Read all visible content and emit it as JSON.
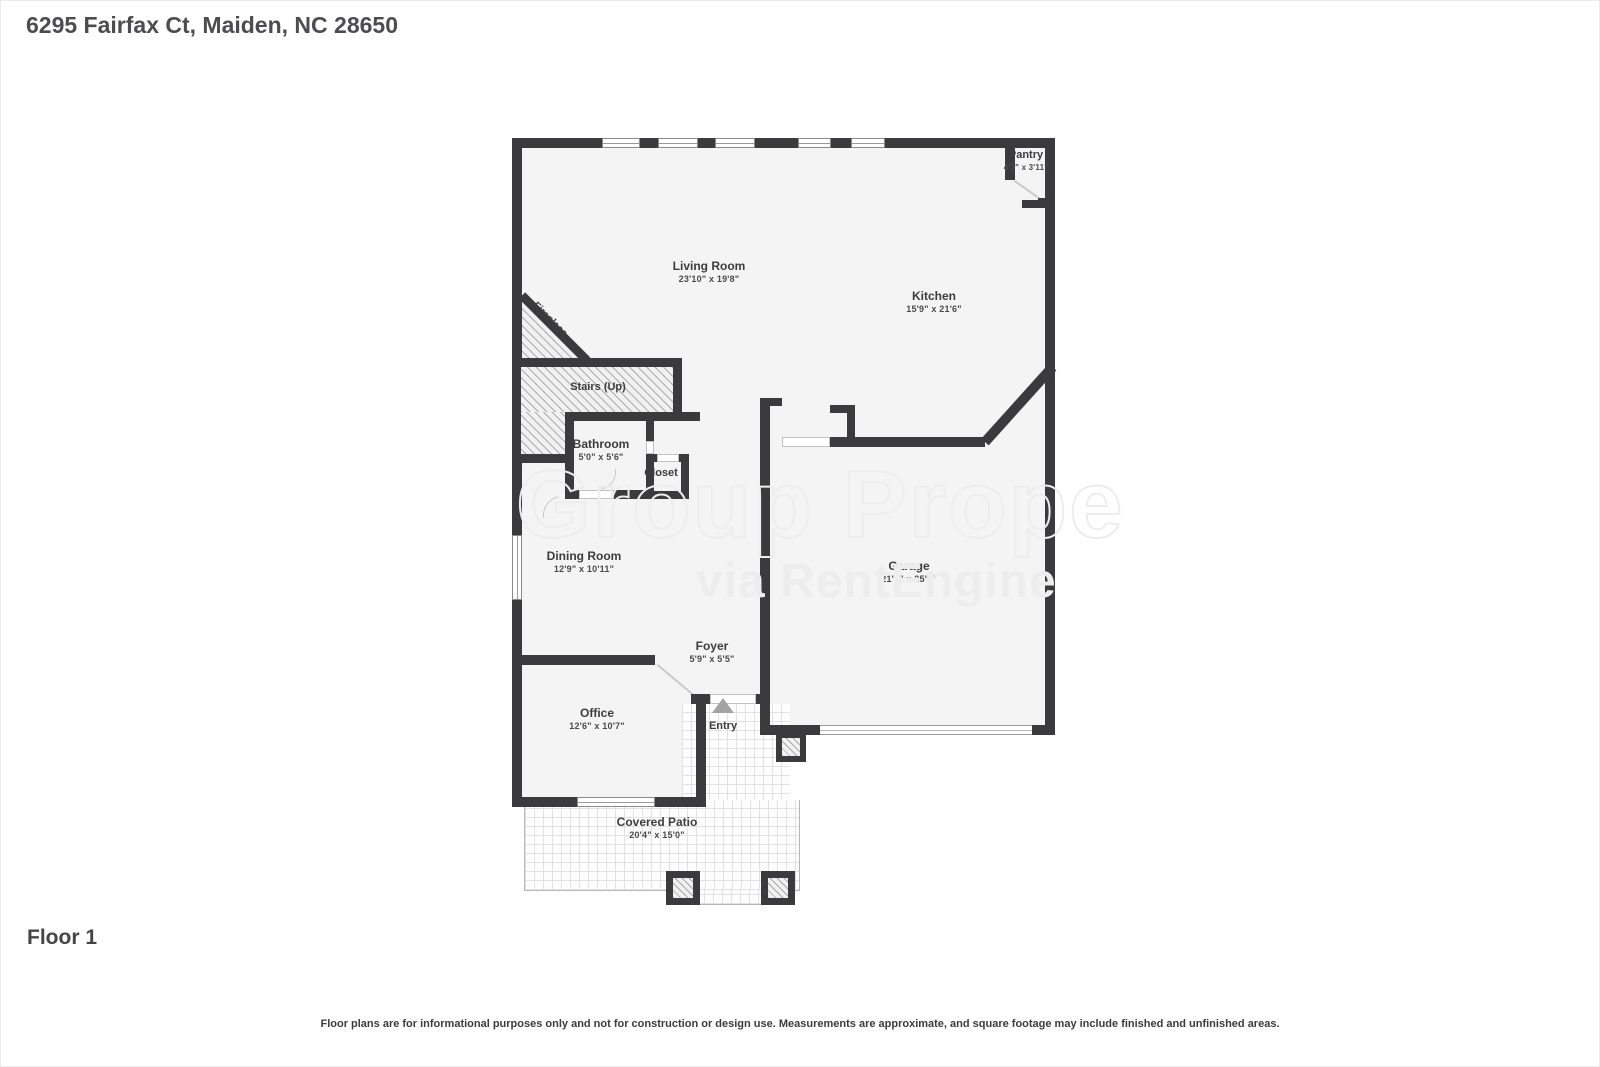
{
  "header": {
    "title": "6295 Fairfax Ct, Maiden, NC 28650"
  },
  "footer": {
    "floor_label": "Floor 1",
    "disclaimer": "Floor plans are for informational purposes only and not for construction or design use. Measurements are approximate, and square footage may include finished and unfinished areas."
  },
  "watermark": {
    "line1": "Group Prope",
    "line2": "via RentEngine"
  },
  "colors": {
    "wall": "#3b3b3d",
    "floor": "#f4f4f4",
    "label_text": "#3d3d3f",
    "watermark": "#ededed",
    "entry_arrow": "#a3a3a3"
  },
  "rooms": {
    "pantry": {
      "name": "Pantry",
      "dims": "4'1\" x 3'11\""
    },
    "living_room": {
      "name": "Living Room",
      "dims": "23'10\" x 19'8\""
    },
    "kitchen": {
      "name": "Kitchen",
      "dims": "15'9\" x 21'6\""
    },
    "stairs": {
      "name": "Stairs (Up)",
      "dims": ""
    },
    "bathroom": {
      "name": "Bathroom",
      "dims": "5'0\" x 5'6\""
    },
    "closet": {
      "name": "Closet",
      "dims": ""
    },
    "dining_room": {
      "name": "Dining Room",
      "dims": "12'9\" x 10'11\""
    },
    "garage": {
      "name": "Garage",
      "dims": "21'5\" x 25'9\""
    },
    "foyer": {
      "name": "Foyer",
      "dims": "5'9\" x 5'5\""
    },
    "office": {
      "name": "Office",
      "dims": "12'6\" x 10'7\""
    },
    "entry": {
      "name": "Entry",
      "dims": ""
    },
    "covered_patio": {
      "name": "Covered Patio",
      "dims": "20'4\" x 15'0\""
    },
    "fireplace": {
      "name": "Fireplace",
      "dims": ""
    }
  }
}
